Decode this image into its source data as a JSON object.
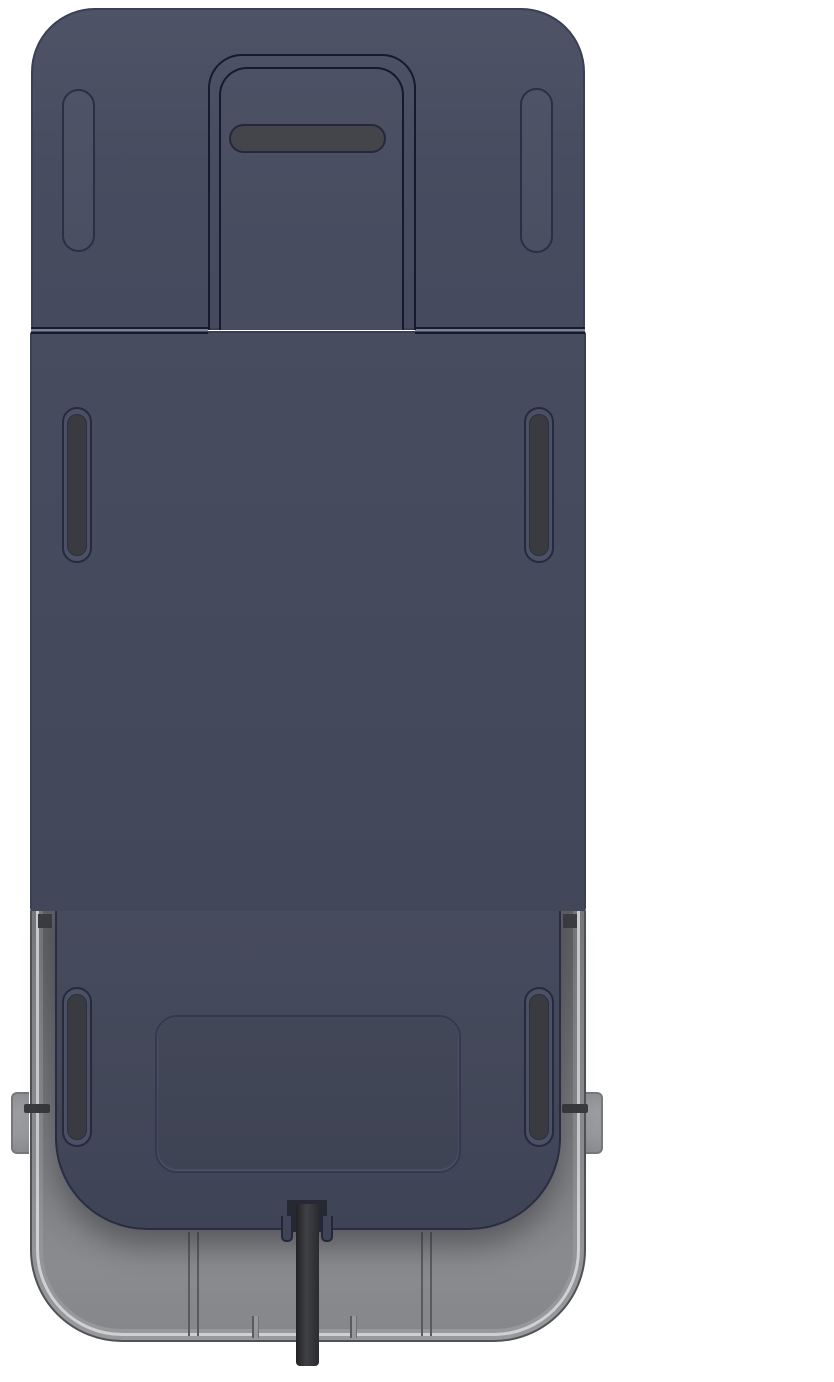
{
  "scene": {
    "type": "product-render",
    "description": "Rear view 3D render of a dark navy device housing seated in a translucent gray mounting tray; a black cable exits through a notch at the bottom center",
    "text_content": "none"
  },
  "colors": {
    "background": "#ffffff",
    "body": "#474c5f",
    "body_light": "#4e5366",
    "body_dark": "#3e4356",
    "outline_soft": "#3a3f54",
    "outline_mid": "#292d42",
    "outline_dark": "#161a2e",
    "outline_slot": "#262a3f",
    "pill_fill": "#4b5064",
    "slot_fill": "#393b41",
    "slot_fill_light": "#43454b",
    "recess_outline": "#343851",
    "shell": "#8e8f93",
    "shell_edge": "#515256",
    "shell_highlight": "#cfd0d2",
    "shell_interior_dark": "#5e5f63",
    "seam_line": "#5a5b5f",
    "clip": "#3c3d42",
    "peg": "#9b9c9f",
    "peg_edge": "#77787b",
    "pin": "#3a3b3f",
    "cable": "#2c2d30",
    "cable_light": "#404145"
  },
  "parts": {
    "top_cover": "top cover panel with rounded top corners",
    "top_pills": "two raised vertical pill embossments, upper left and upper right",
    "latch_tongue": "center latch tongue protruding into a notch cut of the top cover",
    "tongue_slot": "horizontal dark slot in the latch tongue",
    "housing_upper": "main flat rear panel",
    "mid_grip_slots": "two dark vertical grip slots, middle left and middle right",
    "housing_lower": "lower rear panel with rounded bottom corners",
    "bottom_grip_slots": "two dark vertical grip slots, lower left and lower right",
    "recess": "rounded rectangular recess outline, lower center",
    "mounting_tray": "gray translucent mounting tray wrapping the lower housing",
    "tray_seams": "vertical part seams in tray floor",
    "side_pegs": "small gray pegs with dark pins on left and right tray walls",
    "cable": "black cable exiting bottom center notch"
  }
}
